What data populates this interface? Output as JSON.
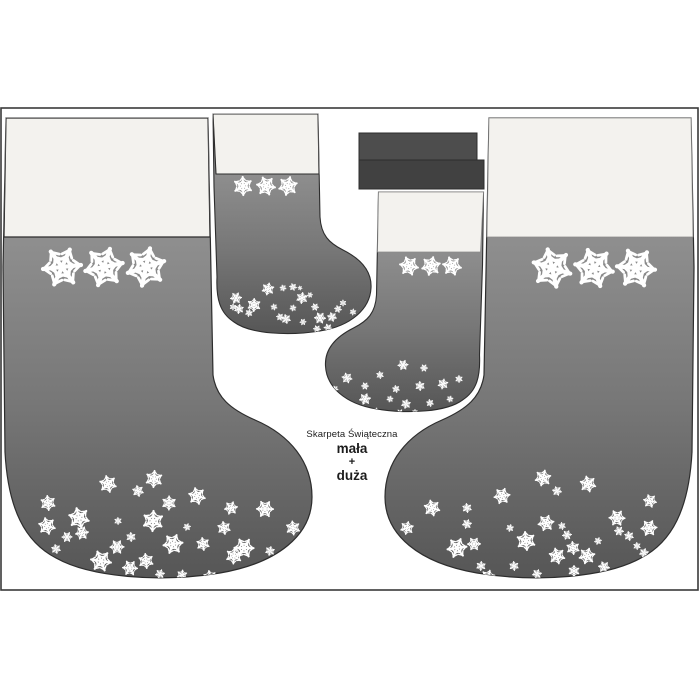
{
  "artwork": {
    "label": {
      "line1": "Skarpeta Świąteczna",
      "line2": "mała",
      "line3": "+",
      "line4": "duża"
    }
  },
  "colors": {
    "bg": "#ffffff",
    "border": "#3a3a3a",
    "outline": "#2d2d2d",
    "cuff": "#f3f2ee",
    "cuff_edge": "#8a8a8a",
    "body_top": "#979797",
    "body_mid": "#8e8e8e",
    "body_low": "#777777",
    "body_bottom": "#565656",
    "strip": "#4d4d4d",
    "strip_dark": "#414141",
    "flake": "#ffffff",
    "ink": "#1c1c1c"
  },
  "flakes": {
    "large_left_row": [
      [
        62,
        160,
        42
      ],
      [
        104,
        160,
        42
      ],
      [
        146,
        160,
        42
      ]
    ],
    "large_right_row": [
      [
        552,
        161,
        42
      ],
      [
        594,
        161,
        42
      ],
      [
        636,
        161,
        42
      ]
    ],
    "small_left_row": [
      [
        243,
        79,
        20
      ],
      [
        266,
        79,
        20
      ],
      [
        288,
        79,
        20
      ]
    ],
    "small_right_row": [
      [
        409,
        159,
        20
      ],
      [
        431,
        159,
        20
      ],
      [
        452,
        159,
        20
      ]
    ],
    "large_left_foot": [
      [
        48,
        396,
        16
      ],
      [
        47,
        419,
        18
      ],
      [
        67,
        430,
        11
      ],
      [
        56,
        442,
        10
      ],
      [
        79,
        411,
        22
      ],
      [
        82,
        426,
        14
      ],
      [
        108,
        377,
        18
      ],
      [
        118,
        414,
        8
      ],
      [
        101,
        454,
        22
      ],
      [
        117,
        440,
        15
      ],
      [
        130,
        461,
        16
      ],
      [
        138,
        384,
        12
      ],
      [
        131,
        430,
        10
      ],
      [
        154,
        372,
        18
      ],
      [
        153,
        414,
        22
      ],
      [
        146,
        454,
        16
      ],
      [
        160,
        467,
        10
      ],
      [
        169,
        396,
        15
      ],
      [
        173,
        437,
        21
      ],
      [
        182,
        468,
        11
      ],
      [
        187,
        420,
        8
      ],
      [
        197,
        389,
        18
      ],
      [
        203,
        437,
        14
      ],
      [
        210,
        470,
        14
      ],
      [
        224,
        421,
        14
      ],
      [
        231,
        401,
        14
      ],
      [
        234,
        449,
        17
      ],
      [
        244,
        441,
        21
      ],
      [
        265,
        402,
        18
      ],
      [
        270,
        444,
        10
      ],
      [
        293,
        421,
        15
      ],
      [
        255,
        466,
        12
      ]
    ],
    "large_right_foot": [
      [
        432,
        401,
        17
      ],
      [
        407,
        421,
        14
      ],
      [
        467,
        401,
        10
      ],
      [
        467,
        417,
        10
      ],
      [
        457,
        441,
        21
      ],
      [
        474,
        437,
        14
      ],
      [
        481,
        459,
        10
      ],
      [
        488,
        470,
        15
      ],
      [
        502,
        389,
        17
      ],
      [
        510,
        421,
        8
      ],
      [
        526,
        434,
        20
      ],
      [
        514,
        459,
        10
      ],
      [
        543,
        371,
        17
      ],
      [
        557,
        384,
        10
      ],
      [
        546,
        416,
        17
      ],
      [
        562,
        419,
        8
      ],
      [
        567,
        428,
        10
      ],
      [
        573,
        441,
        14
      ],
      [
        557,
        449,
        17
      ],
      [
        537,
        467,
        10
      ],
      [
        588,
        377,
        17
      ],
      [
        587,
        449,
        17
      ],
      [
        574,
        464,
        12
      ],
      [
        617,
        411,
        17
      ],
      [
        619,
        424,
        10
      ],
      [
        629,
        429,
        10
      ],
      [
        650,
        394,
        14
      ],
      [
        649,
        421,
        17
      ],
      [
        637,
        439,
        8
      ],
      [
        644,
        446,
        10
      ],
      [
        604,
        460,
        12
      ],
      [
        598,
        434,
        8
      ]
    ],
    "small_left_foot": [
      [
        236,
        191,
        12
      ],
      [
        233,
        200,
        7
      ],
      [
        239,
        202,
        10
      ],
      [
        254,
        198,
        14
      ],
      [
        249,
        206,
        8
      ],
      [
        268,
        182,
        13
      ],
      [
        283,
        181,
        7
      ],
      [
        293,
        180,
        8
      ],
      [
        274,
        200,
        7
      ],
      [
        280,
        210,
        8
      ],
      [
        286,
        212,
        10
      ],
      [
        293,
        201,
        7
      ],
      [
        302,
        191,
        12
      ],
      [
        310,
        188,
        6
      ],
      [
        315,
        200,
        8
      ],
      [
        320,
        211,
        12
      ],
      [
        332,
        210,
        10
      ],
      [
        338,
        202,
        8
      ],
      [
        343,
        196,
        7
      ],
      [
        317,
        222,
        8
      ],
      [
        303,
        215,
        7
      ],
      [
        328,
        221,
        9
      ],
      [
        353,
        205,
        7
      ],
      [
        300,
        181,
        5
      ]
    ],
    "small_right_foot": [
      [
        403,
        258,
        11
      ],
      [
        380,
        268,
        8
      ],
      [
        424,
        261,
        8
      ],
      [
        347,
        271,
        11
      ],
      [
        365,
        279,
        8
      ],
      [
        335,
        282,
        7
      ],
      [
        396,
        282,
        8
      ],
      [
        443,
        277,
        11
      ],
      [
        459,
        272,
        8
      ],
      [
        420,
        279,
        10
      ],
      [
        365,
        292,
        12
      ],
      [
        390,
        292,
        7
      ],
      [
        406,
        297,
        10
      ],
      [
        342,
        297,
        8
      ],
      [
        430,
        296,
        8
      ],
      [
        450,
        292,
        7
      ],
      [
        400,
        306,
        8
      ],
      [
        376,
        304,
        7
      ],
      [
        415,
        305,
        6
      ],
      [
        356,
        303,
        6
      ]
    ]
  }
}
